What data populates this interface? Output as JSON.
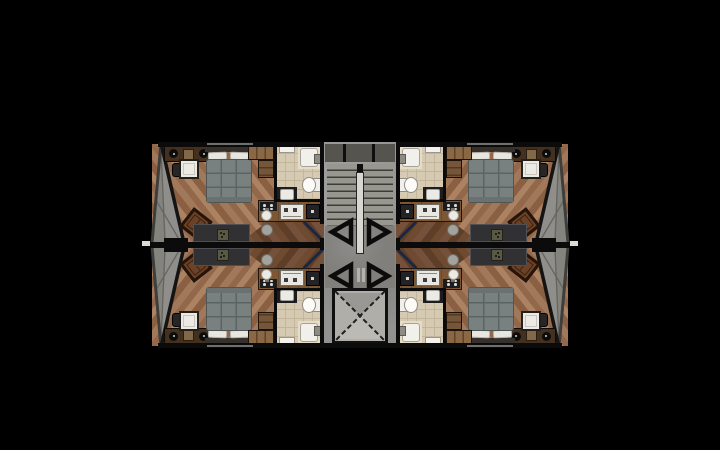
{
  "scene": {
    "type": "architectural-floor-plan",
    "description": "Typical floor plan: four mirrored studio apartments around a central stair and elevator core",
    "background": "#000000"
  },
  "palette": {
    "wall": "#0b0b0b",
    "wood_a": "#a2785a",
    "wood_b": "#93674a",
    "wood_c": "#ab8262",
    "wood_d": "#8a5f42",
    "wood_dark_a": "#6e4a30",
    "wood_dark_b": "#5f3e27",
    "wood_dark_c": "#75503a",
    "terrace": "#8f8e8a",
    "terrace_shadow": "#7c7b77",
    "concrete": "#929290",
    "lobby": "#807f7b",
    "elevator": "#b0aea9",
    "bath_floor": "#d6cbb2",
    "bath_tile_line": "#c2b69c",
    "shower": "#e6ddc6",
    "white": "#eceae5",
    "quilt": "#788080",
    "quilt_line": "#5c6463",
    "headboard": "#35302b",
    "pillow": "#e8e6e0",
    "wardrobe": "#8a6745",
    "closet": "#75563a",
    "sideboard": "#44301f",
    "console": "#313134",
    "armchair": "#6b4228",
    "armchair_frame": "#241409",
    "counter": "#7d5634",
    "appliance_dark": "#232325",
    "stool": "#a3a29c",
    "door_swing": "#1b2742",
    "rail": "#d7d6d1",
    "tick": "#d9d9d6",
    "tread_line": "#3c3c3a",
    "stair_band": "#55544f"
  },
  "units": [
    {
      "id": "unit-top-left",
      "quadrant": "top-left",
      "mirror_x": false,
      "mirror_y": false
    },
    {
      "id": "unit-top-right",
      "quadrant": "top-right",
      "mirror_x": true,
      "mirror_y": false
    },
    {
      "id": "unit-bottom-left",
      "quadrant": "bottom-left",
      "mirror_x": false,
      "mirror_y": true
    },
    {
      "id": "unit-bottom-right",
      "quadrant": "bottom-right",
      "mirror_x": true,
      "mirror_y": true
    }
  ],
  "core": {
    "rooms": [
      "stairwell",
      "elevator-lobby",
      "elevator-shaft"
    ],
    "door_swing_triangles": 4,
    "stair_flights": 2
  },
  "unit_furniture": [
    "glazed-terrace",
    "sideboard-with-lamps",
    "dining-table",
    "dining-chair",
    "bed",
    "headboard",
    "pillows",
    "quilt",
    "wardrobe",
    "closet",
    "armchair",
    "tv-console",
    "plant",
    "kitchen-counter",
    "cooktop",
    "kitchen-sink",
    "oven",
    "dark-appliance",
    "bar-stool",
    "bathroom",
    "shower",
    "shower-tray",
    "toilet",
    "vanity",
    "vanity-sink",
    "mirror-cabinet",
    "entry-door-swing"
  ]
}
